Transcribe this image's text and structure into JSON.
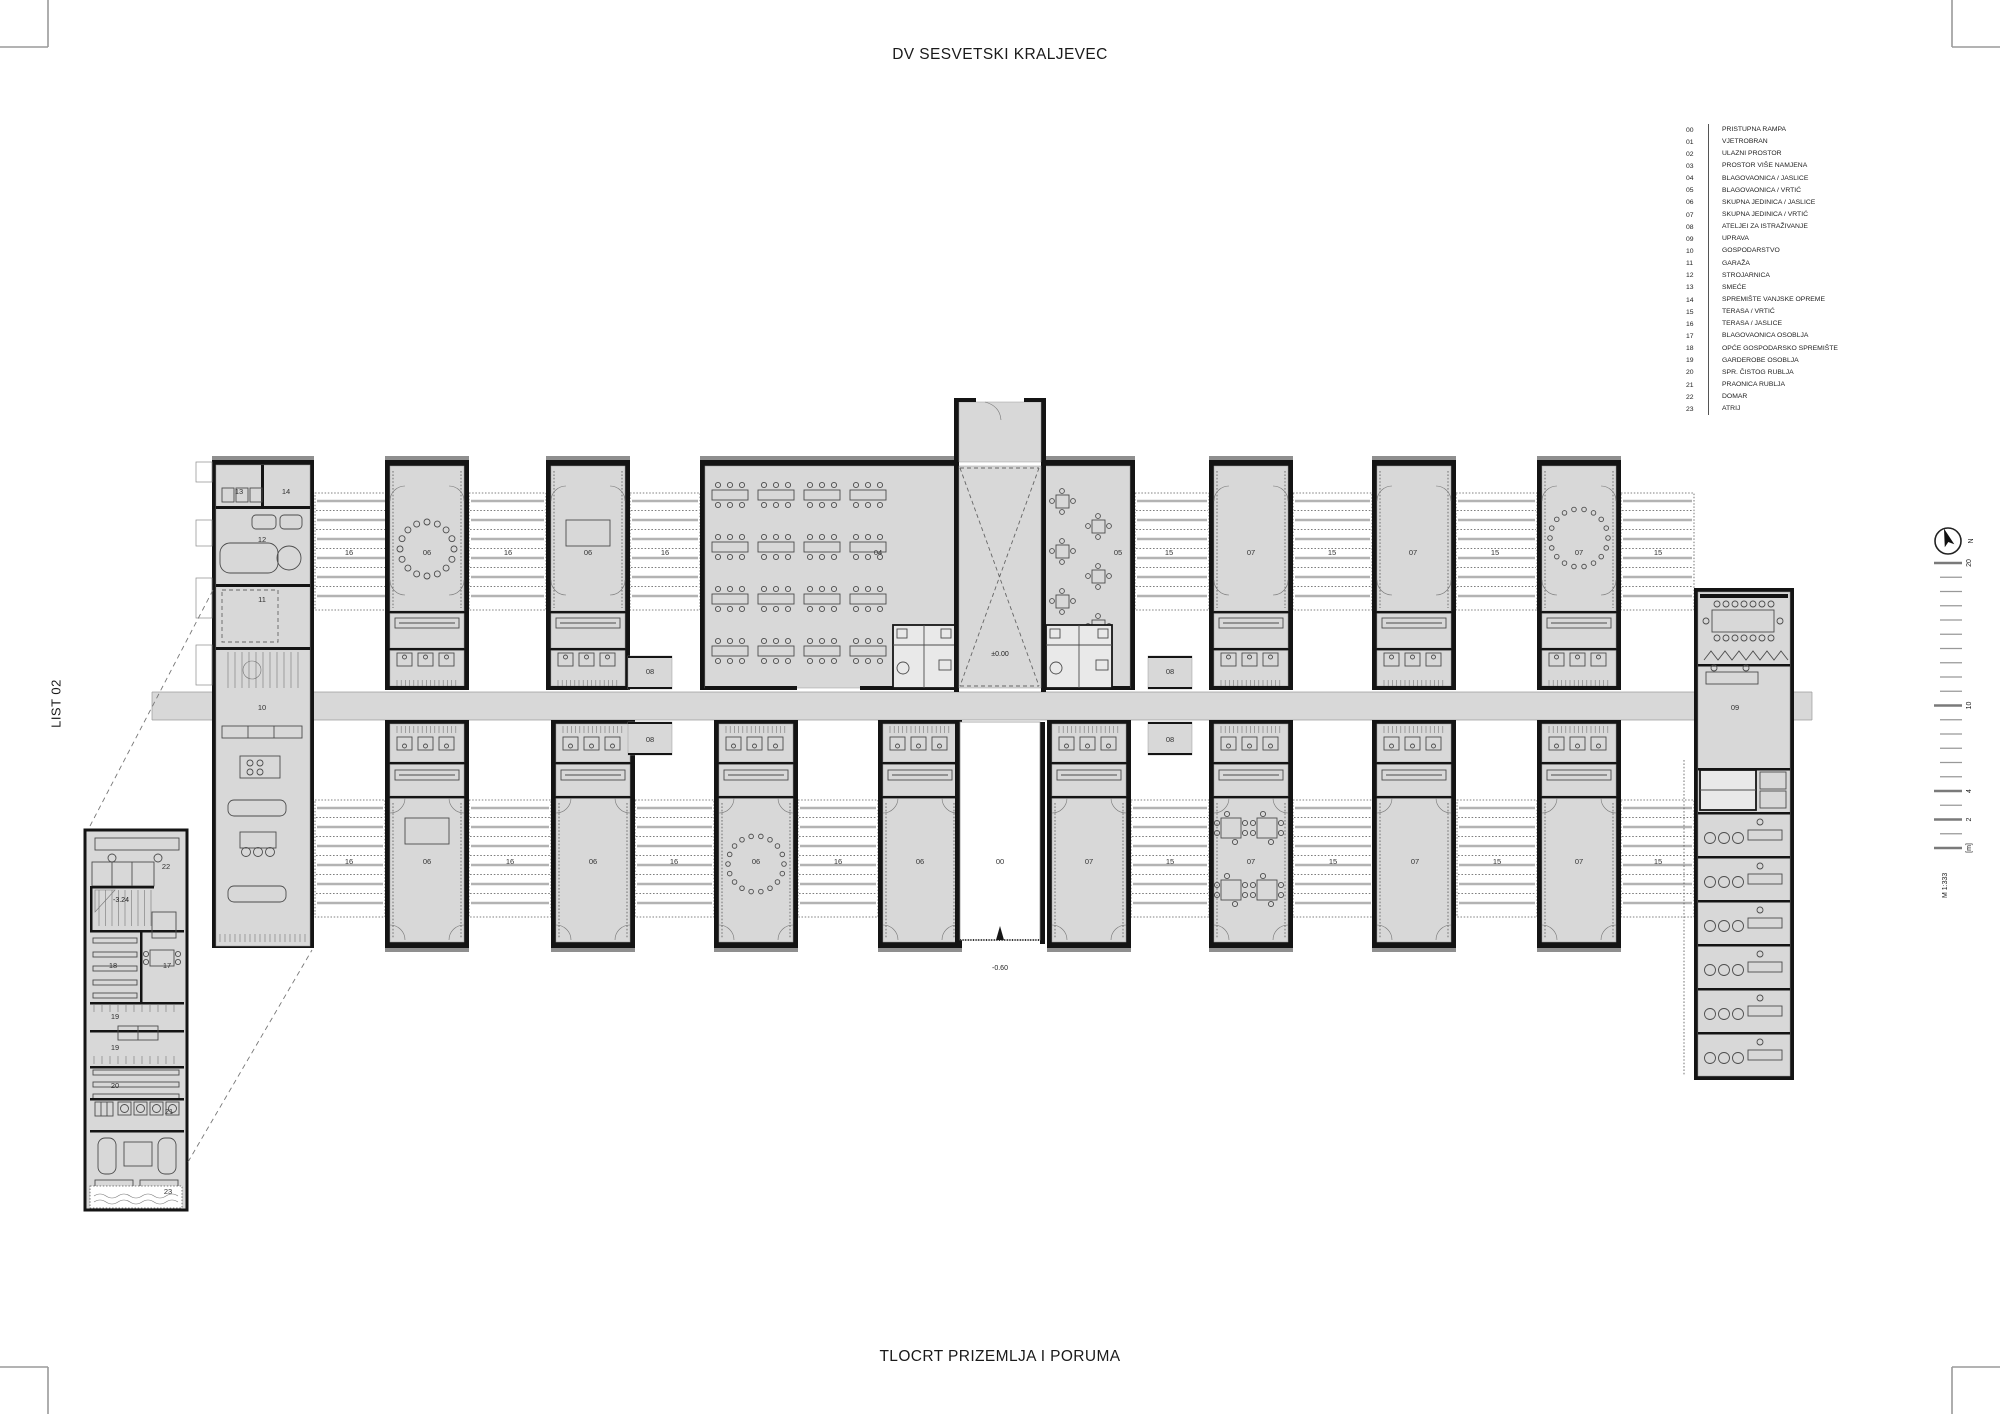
{
  "page": {
    "title": "DV SESVETSKI KRALJEVEC",
    "subtitle": "TLOCRT PRIZEMLJA I PORUMA",
    "sheet_label": "LIST 02"
  },
  "legend": {
    "items": [
      {
        "code": "00",
        "label": "PRISTUPNA RAMPA"
      },
      {
        "code": "01",
        "label": "VJETROBRAN"
      },
      {
        "code": "02",
        "label": "ULAZNI PROSTOR"
      },
      {
        "code": "03",
        "label": "PROSTOR VIŠE NAMJENA"
      },
      {
        "code": "04",
        "label": "BLAGOVAONICA / JASLICE"
      },
      {
        "code": "05",
        "label": "BLAGOVAONICA / VRTIĆ"
      },
      {
        "code": "06",
        "label": "SKUPNA JEDINICA / JASLICE"
      },
      {
        "code": "07",
        "label": "SKUPNA JEDINICA / VRTIĆ"
      },
      {
        "code": "08",
        "label": "ATELJEI ZA ISTRAŽIVANJE"
      },
      {
        "code": "09",
        "label": "UPRAVA"
      },
      {
        "code": "10",
        "label": "GOSPODARSTVO"
      },
      {
        "code": "11",
        "label": "GARAŽA"
      },
      {
        "code": "12",
        "label": "STROJARNICA"
      },
      {
        "code": "13",
        "label": "SMEĆE"
      },
      {
        "code": "14",
        "label": "SPREMIŠTE VANJSKE OPREME"
      },
      {
        "code": "15",
        "label": "TERASA / VRTIĆ"
      },
      {
        "code": "16",
        "label": "TERASA / JASLICE"
      },
      {
        "code": "17",
        "label": "BLAGOVAONICA OSOBLJA"
      },
      {
        "code": "18",
        "label": "OPĆE GOSPODARSKO SPREMIŠTE"
      },
      {
        "code": "19",
        "label": "GARDEROBE OSOBLJA"
      },
      {
        "code": "20",
        "label": "SPR. ČISTOG RUBLJA"
      },
      {
        "code": "21",
        "label": "PRAONICA RUBLJA"
      },
      {
        "code": "22",
        "label": "DOMAR"
      },
      {
        "code": "23",
        "label": "ATRIJ"
      }
    ]
  },
  "plan": {
    "room_labels": [
      {
        "code": "13",
        "x": 239,
        "y": 494
      },
      {
        "code": "14",
        "x": 286,
        "y": 494
      },
      {
        "code": "12",
        "x": 262,
        "y": 542
      },
      {
        "code": "11",
        "x": 262,
        "y": 602
      },
      {
        "code": "10",
        "x": 262,
        "y": 710
      },
      {
        "code": "16",
        "x": 349,
        "y": 555
      },
      {
        "code": "06",
        "x": 427,
        "y": 555
      },
      {
        "code": "16",
        "x": 508,
        "y": 555
      },
      {
        "code": "06",
        "x": 588,
        "y": 555
      },
      {
        "code": "16",
        "x": 665,
        "y": 555
      },
      {
        "code": "04",
        "x": 878,
        "y": 555
      },
      {
        "code": "05",
        "x": 1118,
        "y": 555
      },
      {
        "code": "15",
        "x": 1169,
        "y": 555
      },
      {
        "code": "07",
        "x": 1251,
        "y": 555
      },
      {
        "code": "15",
        "x": 1332,
        "y": 555
      },
      {
        "code": "07",
        "x": 1413,
        "y": 555
      },
      {
        "code": "15",
        "x": 1495,
        "y": 555
      },
      {
        "code": "07",
        "x": 1579,
        "y": 555
      },
      {
        "code": "15",
        "x": 1658,
        "y": 555
      },
      {
        "code": "08",
        "x": 650,
        "y": 674
      },
      {
        "code": "08",
        "x": 650,
        "y": 742
      },
      {
        "code": "08",
        "x": 1170,
        "y": 674
      },
      {
        "code": "08",
        "x": 1170,
        "y": 742
      },
      {
        "code": "09",
        "x": 1735,
        "y": 710
      },
      {
        "code": "16",
        "x": 349,
        "y": 864
      },
      {
        "code": "06",
        "x": 427,
        "y": 864
      },
      {
        "code": "16",
        "x": 510,
        "y": 864
      },
      {
        "code": "06",
        "x": 593,
        "y": 864
      },
      {
        "code": "16",
        "x": 674,
        "y": 864
      },
      {
        "code": "06",
        "x": 756,
        "y": 864
      },
      {
        "code": "16",
        "x": 838,
        "y": 864
      },
      {
        "code": "06",
        "x": 920,
        "y": 864
      },
      {
        "code": "00",
        "x": 1000,
        "y": 864
      },
      {
        "code": "07",
        "x": 1089,
        "y": 864
      },
      {
        "code": "15",
        "x": 1170,
        "y": 864
      },
      {
        "code": "07",
        "x": 1251,
        "y": 864
      },
      {
        "code": "15",
        "x": 1333,
        "y": 864
      },
      {
        "code": "07",
        "x": 1415,
        "y": 864
      },
      {
        "code": "15",
        "x": 1497,
        "y": 864
      },
      {
        "code": "07",
        "x": 1579,
        "y": 864
      },
      {
        "code": "15",
        "x": 1658,
        "y": 864
      },
      {
        "code": "22",
        "x": 166,
        "y": 869
      },
      {
        "code": "18",
        "x": 113,
        "y": 968
      },
      {
        "code": "17",
        "x": 167,
        "y": 968
      },
      {
        "code": "19",
        "x": 115,
        "y": 1019
      },
      {
        "code": "19",
        "x": 115,
        "y": 1050
      },
      {
        "code": "20",
        "x": 115,
        "y": 1088
      },
      {
        "code": "21",
        "x": 169,
        "y": 1114
      },
      {
        "code": "23",
        "x": 168,
        "y": 1194
      }
    ],
    "level_labels": [
      {
        "text": "±0.00",
        "x": 1000,
        "y": 656
      },
      {
        "text": "-0.60",
        "x": 1000,
        "y": 970
      },
      {
        "text": "-3.24",
        "x": 121,
        "y": 902
      }
    ]
  },
  "scalebar": {
    "north_label": "N",
    "scale_text": "M 1:333",
    "tick_labels": [
      {
        "value": "20",
        "m": 20
      },
      {
        "value": "10",
        "m": 10
      },
      {
        "value": "4",
        "m": 4
      },
      {
        "value": "2",
        "m": 2
      },
      {
        "value": "[m]",
        "m": 0
      }
    ]
  }
}
